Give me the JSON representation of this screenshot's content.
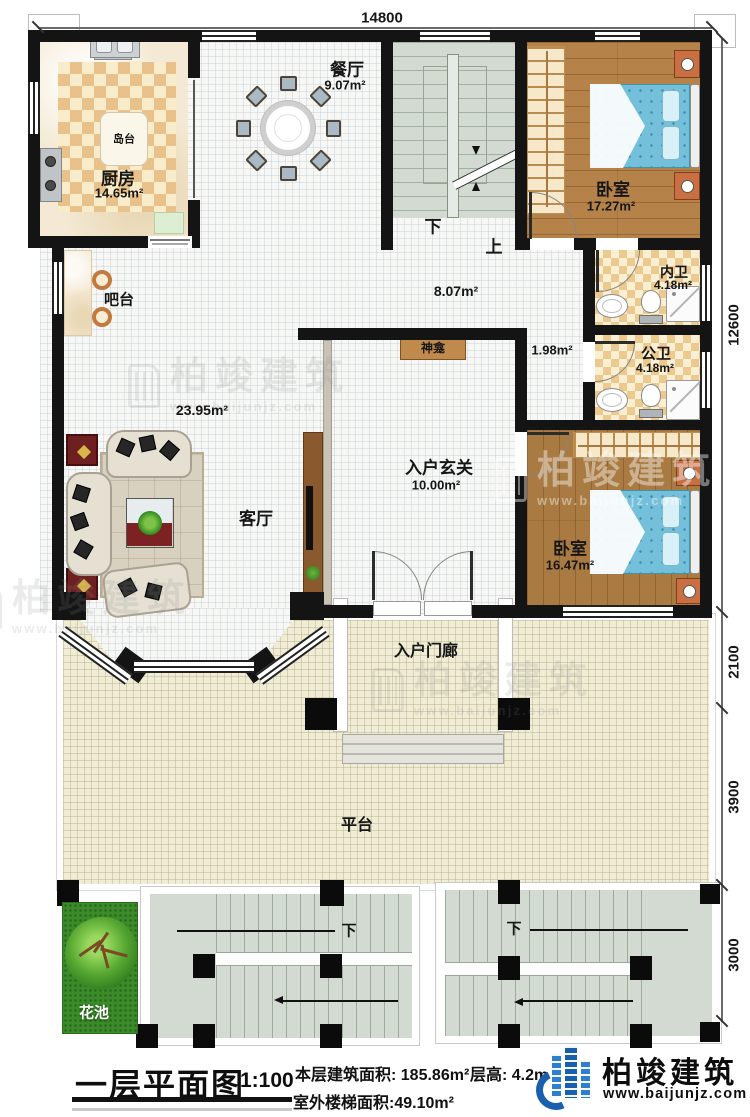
{
  "plan": {
    "title": "一层平面图",
    "scale": "1:100",
    "stats": {
      "area": "本层建筑面积: 185.86m²",
      "height": "层高: 4.2m",
      "stairArea": "室外楼梯面积:49.10m²"
    }
  },
  "brand": {
    "name": "柏竣建筑",
    "url": "www.baijunjz.com"
  },
  "watermark": {
    "name": "柏竣建筑",
    "url": "www.baijunjz.com"
  },
  "dimensions": {
    "top": "14800",
    "right": [
      "12600",
      "2100",
      "3900",
      "3000"
    ]
  },
  "stairs": {
    "down": "下",
    "up": "上"
  },
  "rooms": {
    "kitchen": {
      "name": "厨房",
      "area": "14.65m²"
    },
    "island": {
      "name": "岛台"
    },
    "dining": {
      "name": "餐厅",
      "area": "9.07m²"
    },
    "bedroom1": {
      "name": "卧室",
      "area": "17.27m²"
    },
    "innerBath": {
      "name": "内卫",
      "area": "4.18m²"
    },
    "publicBath": {
      "name": "公卫",
      "area": "4.18m²"
    },
    "corridor": {
      "area": "8.07m²"
    },
    "nook": {
      "area": "1.98m²"
    },
    "shrine": {
      "name": "神龛"
    },
    "bar": {
      "name": "吧台"
    },
    "living": {
      "name": "客厅",
      "area": "23.95m²"
    },
    "foyer": {
      "name": "入户玄关",
      "area": "10.00m²"
    },
    "bedroom2": {
      "name": "卧室",
      "area": "16.47m²"
    },
    "porch": {
      "name": "入户门廊"
    },
    "terrace": {
      "name": "平台"
    },
    "flowerBed": {
      "name": "花池"
    }
  }
}
